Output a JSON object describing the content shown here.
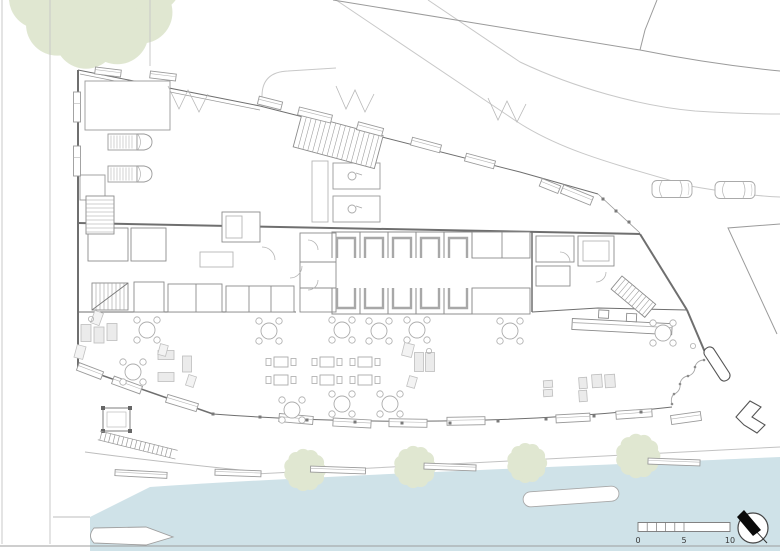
{
  "title": "waterfront-restaurant-site-plan",
  "colors": {
    "water": "#cfe2e8",
    "foliage": "#e0e7d1",
    "road_line": "#c8c8c8",
    "neighbor_line": "#9b9b9b",
    "wall": "#6f6f6f",
    "detail": "#9a9a9a",
    "light_detail": "#b5b5b5",
    "furniture_fill": "#ebebeb",
    "text": "#3a3a3a",
    "needle": "#0a0a0a"
  },
  "scale_bar": {
    "labels": [
      "0",
      "5",
      "10"
    ],
    "minor_segments": 5
  },
  "north_arrow": {
    "shape": "circle-with-black-needle"
  },
  "trees": {
    "large": {
      "x": 94,
      "y": -18,
      "r": 78
    },
    "waterfront": [
      {
        "x": 305,
        "y": 470,
        "r": 19
      },
      {
        "x": 415,
        "y": 467,
        "r": 19
      },
      {
        "x": 527,
        "y": 463,
        "r": 18
      },
      {
        "x": 638,
        "y": 456,
        "r": 20
      }
    ]
  },
  "vehicles": {
    "vans": [
      [
        130,
        142
      ],
      [
        130,
        174
      ]
    ],
    "cars": [
      [
        672,
        189
      ],
      [
        735,
        190
      ]
    ]
  },
  "benches": {
    "yard_top": [
      [
        108,
        72,
        26,
        7,
        7
      ],
      [
        163,
        76,
        26,
        7,
        7
      ]
    ],
    "yard_left": [
      [
        77,
        107,
        7,
        30,
        0
      ],
      [
        77,
        161,
        7,
        30,
        0
      ]
    ],
    "canopy": [
      [
        270,
        103,
        24,
        8,
        14
      ],
      [
        315,
        115,
        34,
        8,
        14
      ],
      [
        370,
        129,
        26,
        8,
        15
      ],
      [
        426,
        145,
        30,
        8,
        15
      ],
      [
        480,
        161,
        30,
        8,
        15
      ],
      [
        550,
        186,
        20,
        8,
        22
      ],
      [
        577,
        195,
        32,
        9,
        22
      ]
    ],
    "south": [
      [
        90,
        371,
        26,
        8,
        21
      ],
      [
        127,
        385,
        30,
        8,
        20
      ],
      [
        182,
        403,
        32,
        8,
        17
      ],
      [
        296,
        419,
        34,
        8,
        5
      ],
      [
        352,
        423,
        38,
        8,
        3
      ],
      [
        408,
        423,
        38,
        8,
        1
      ],
      [
        466,
        421,
        38,
        8,
        -1
      ],
      [
        573,
        418,
        34,
        8,
        -3
      ],
      [
        634,
        414,
        36,
        8,
        -4
      ],
      [
        686,
        418,
        30,
        9,
        -8
      ]
    ],
    "promenade": [
      [
        141,
        474,
        52,
        6,
        3
      ],
      [
        238,
        473,
        46,
        6,
        2
      ],
      [
        338,
        470,
        55,
        6,
        2
      ],
      [
        450,
        467,
        52,
        6,
        2
      ],
      [
        674,
        462,
        52,
        6,
        2
      ]
    ]
  },
  "furniture": {
    "round_tables": [
      [
        147,
        330
      ],
      [
        269,
        331
      ],
      [
        342,
        330
      ],
      [
        379,
        331
      ],
      [
        417,
        330
      ],
      [
        510,
        331
      ],
      [
        663,
        333
      ],
      [
        133,
        372
      ],
      [
        342,
        404
      ],
      [
        390,
        404
      ],
      [
        292,
        410
      ]
    ],
    "pair_tables": [
      [
        281,
        362
      ],
      [
        281,
        380
      ],
      [
        327,
        362
      ],
      [
        327,
        380
      ],
      [
        365,
        362
      ],
      [
        365,
        380
      ]
    ],
    "lounge_rects": [
      [
        86,
        333,
        10,
        17,
        0
      ],
      [
        99,
        335,
        10,
        16,
        0
      ],
      [
        112,
        332,
        10,
        17,
        0
      ],
      [
        166,
        355,
        16,
        9,
        0
      ],
      [
        166,
        377,
        16,
        9,
        0
      ],
      [
        187,
        364,
        9,
        16,
        0
      ],
      [
        419,
        362,
        9,
        19,
        0
      ],
      [
        430,
        362,
        9,
        19,
        0
      ],
      [
        548,
        384,
        9,
        7,
        -4
      ],
      [
        548,
        393,
        9,
        7,
        -4
      ],
      [
        583,
        383,
        8,
        11,
        -4
      ],
      [
        583,
        396,
        8,
        11,
        -4
      ],
      [
        597,
        381,
        10,
        13,
        -4
      ],
      [
        610,
        381,
        10,
        13,
        -4
      ]
    ],
    "lounge_diamonds": [
      [
        97,
        318,
        9,
        13,
        20
      ],
      [
        80,
        352,
        9,
        13,
        15
      ],
      [
        163,
        350,
        8,
        11,
        15
      ],
      [
        191,
        381,
        8,
        11,
        18
      ],
      [
        408,
        350,
        10,
        13,
        14
      ],
      [
        412,
        382,
        8,
        11,
        16
      ]
    ],
    "small_circles": [
      [
        91,
        319
      ],
      [
        429,
        351
      ],
      [
        693,
        346
      ]
    ]
  },
  "booths": {
    "x0": 332,
    "pitch": 28,
    "count": 5,
    "top_y": 232,
    "bot_y": 288,
    "cell_h": 26
  },
  "stairs": [
    {
      "x": 86,
      "y": 196,
      "w": 28,
      "h": 38,
      "rot": 0,
      "axis": "h",
      "step": 4,
      "diag": false
    },
    {
      "x": 92,
      "y": 283,
      "w": 36,
      "h": 27,
      "rot": 0,
      "axis": "v",
      "step": 4,
      "diag": true
    },
    {
      "x": 302,
      "y": 114,
      "w": 84,
      "h": 34,
      "rot": 15,
      "axis": "v",
      "step": 5,
      "diag": false
    },
    {
      "x": 622,
      "y": 276,
      "w": 44,
      "h": 17,
      "rot": 40,
      "axis": "v",
      "step": 4.5,
      "diag": false
    }
  ],
  "posts": {
    "south": [
      [
        213,
        414
      ],
      [
        260,
        417
      ],
      [
        307,
        420
      ],
      [
        355,
        422
      ],
      [
        402,
        423
      ],
      [
        450,
        423
      ],
      [
        498,
        421
      ],
      [
        546,
        419
      ],
      [
        594,
        416
      ],
      [
        641,
        412
      ]
    ],
    "northeast": [
      [
        603,
        199
      ],
      [
        616,
        211
      ],
      [
        629,
        222
      ]
    ]
  }
}
